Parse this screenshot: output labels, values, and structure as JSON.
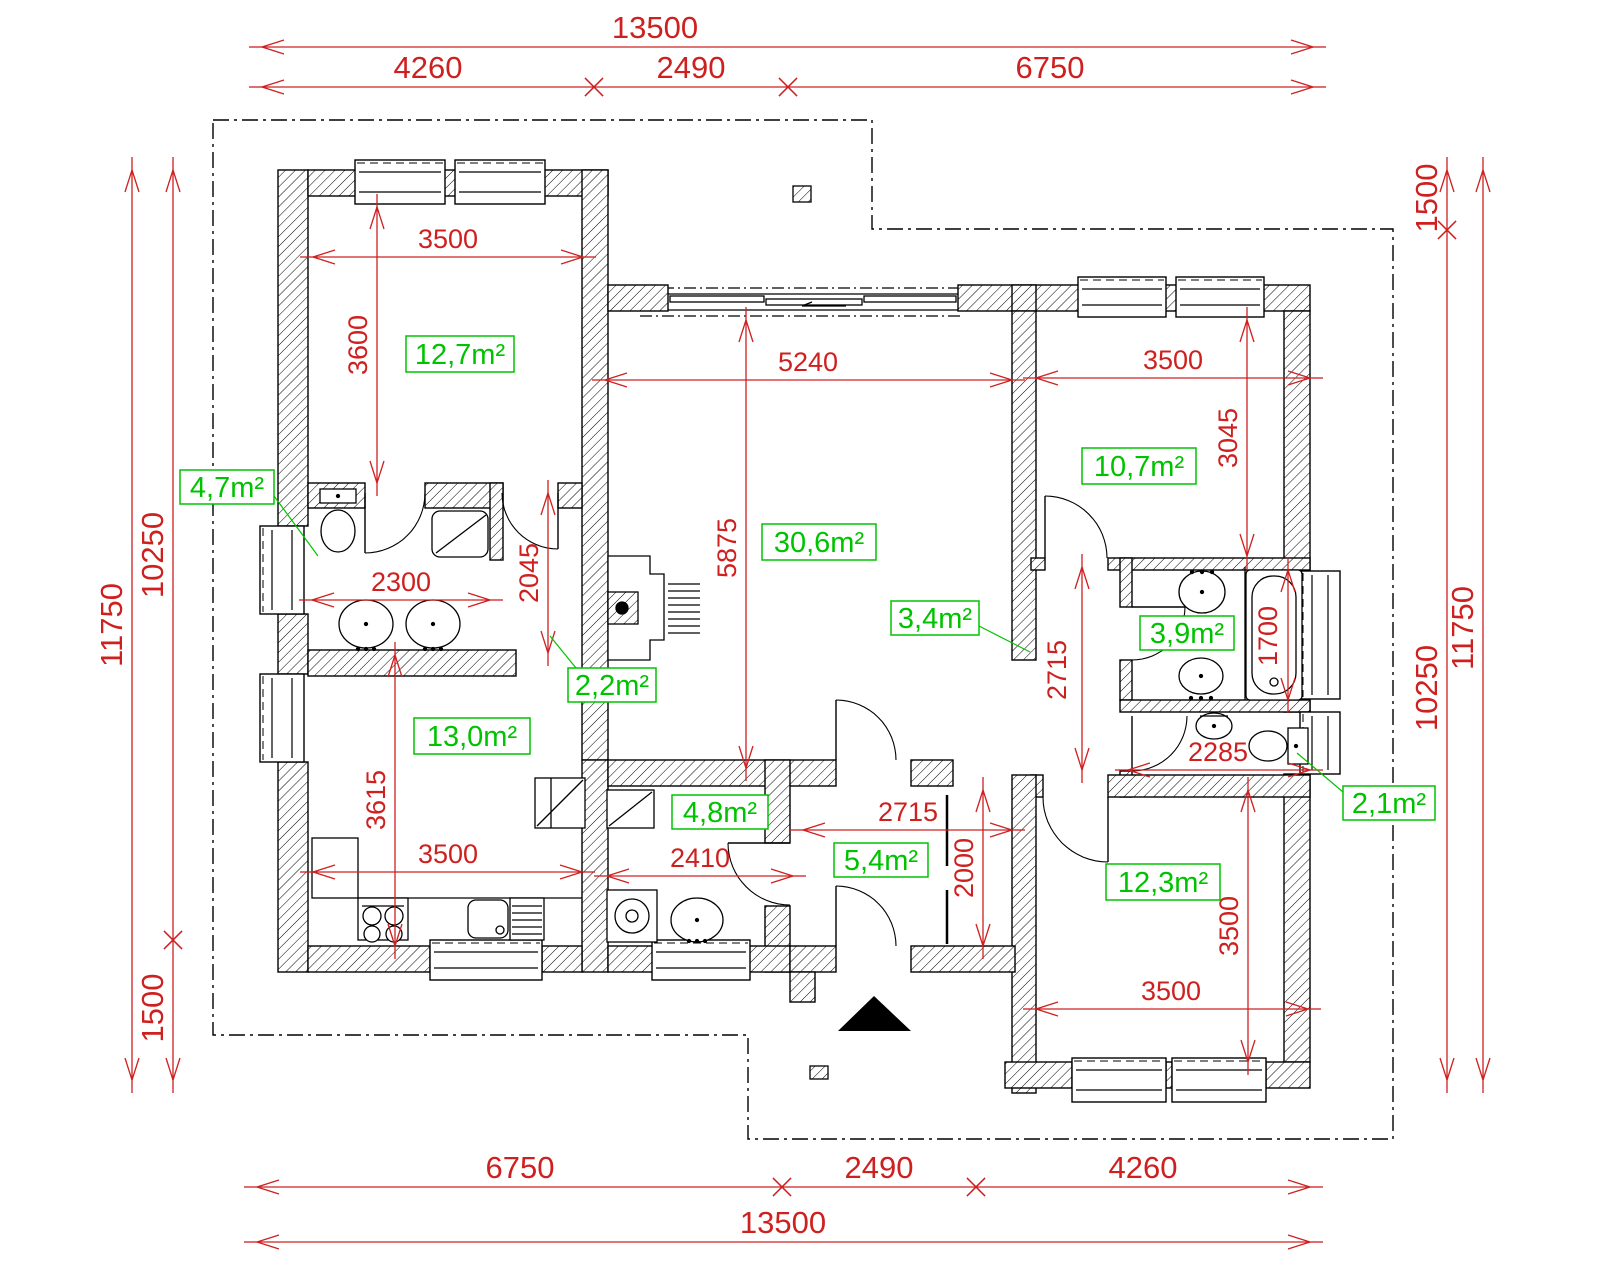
{
  "drawing_title": "house floor plan",
  "colors": {
    "dimension_red": "#cf2020",
    "area_green": "#00c300",
    "line_black": "#000000",
    "background": "#ffffff"
  },
  "dimensions": [
    {
      "label": "13500",
      "ext": true,
      "dir": "h",
      "y": 47,
      "x1": 262,
      "x2": 1313,
      "tx": 655,
      "ty": 38,
      "e1": "arrow",
      "e2": "arrow"
    },
    {
      "label": "4260",
      "ext": true,
      "dir": "h",
      "y": 87,
      "x1": 262,
      "x2": 594,
      "tx": 428,
      "ty": 78,
      "e1": "arrow",
      "e2": "cross"
    },
    {
      "label": "2490",
      "ext": true,
      "dir": "h",
      "y": 87,
      "x1": 594,
      "x2": 788,
      "tx": 691,
      "ty": 78,
      "e1": "cross",
      "e2": "cross"
    },
    {
      "label": "6750",
      "ext": true,
      "dir": "h",
      "y": 87,
      "x1": 788,
      "x2": 1313,
      "tx": 1050,
      "ty": 78,
      "e1": "cross",
      "e2": "arrow"
    },
    {
      "label": "6750",
      "ext": true,
      "dir": "h",
      "y": 1187,
      "x1": 257,
      "x2": 782,
      "tx": 520,
      "ty": 1178,
      "e1": "arrow",
      "e2": "cross"
    },
    {
      "label": "2490",
      "ext": true,
      "dir": "h",
      "y": 1187,
      "x1": 782,
      "x2": 976,
      "tx": 879,
      "ty": 1178,
      "e1": "cross",
      "e2": "cross"
    },
    {
      "label": "4260",
      "ext": true,
      "dir": "h",
      "y": 1187,
      "x1": 976,
      "x2": 1310,
      "tx": 1143,
      "ty": 1178,
      "e1": "cross",
      "e2": "arrow"
    },
    {
      "label": "13500",
      "ext": true,
      "dir": "h",
      "y": 1242,
      "x1": 257,
      "x2": 1310,
      "tx": 783,
      "ty": 1233,
      "e1": "arrow",
      "e2": "arrow"
    },
    {
      "label": "11750",
      "ext": true,
      "dir": "v",
      "x": 132,
      "y1": 170,
      "y2": 1080,
      "tx": 122,
      "ty": 625,
      "e1": "arrow",
      "e2": "arrow"
    },
    {
      "label": "10250",
      "ext": true,
      "dir": "v",
      "x": 173,
      "y1": 170,
      "y2": 940,
      "tx": 163,
      "ty": 555,
      "e1": "arrow",
      "e2": "cross"
    },
    {
      "label": "1500",
      "ext": true,
      "dir": "v",
      "x": 173,
      "y1": 940,
      "y2": 1080,
      "tx": 163,
      "ty": 1008,
      "e1": "cross",
      "e2": "arrow"
    },
    {
      "label": "1500",
      "ext": true,
      "dir": "v",
      "x": 1447,
      "y1": 170,
      "y2": 230,
      "tx": 1437,
      "ty": 198,
      "e1": "arrow",
      "e2": "cross"
    },
    {
      "label": "10250",
      "ext": true,
      "dir": "v",
      "x": 1447,
      "y1": 230,
      "y2": 1080,
      "tx": 1437,
      "ty": 688,
      "e1": "cross",
      "e2": "arrow"
    },
    {
      "label": "11750",
      "ext": true,
      "dir": "v",
      "x": 1483,
      "y1": 170,
      "y2": 1080,
      "tx": 1473,
      "ty": 628,
      "e1": "arrow",
      "e2": "arrow"
    },
    {
      "label": "3500",
      "dir": "h",
      "y": 257,
      "x1": 313,
      "x2": 583,
      "tx": 448,
      "ty": 248,
      "e1": "arrow",
      "e2": "arrow"
    },
    {
      "label": "3600",
      "dir": "v",
      "x": 377,
      "y1": 207,
      "y2": 483,
      "tx": 367,
      "ty": 345,
      "e1": "arrow",
      "e2": "arrow"
    },
    {
      "label": "2300",
      "dir": "h",
      "y": 600,
      "x1": 312,
      "x2": 490,
      "tx": 401,
      "ty": 591,
      "e1": "arrow",
      "e2": "arrow"
    },
    {
      "label": "2045",
      "dir": "v",
      "x": 548,
      "y1": 493,
      "y2": 653,
      "tx": 538,
      "ty": 573,
      "e1": "arrow",
      "e2": "arrow"
    },
    {
      "label": "5240",
      "dir": "h",
      "y": 380,
      "x1": 605,
      "x2": 1012,
      "tx": 808,
      "ty": 371,
      "e1": "arrow",
      "e2": "arrow"
    },
    {
      "label": "5875",
      "dir": "v",
      "x": 746,
      "y1": 320,
      "y2": 768,
      "tx": 736,
      "ty": 548,
      "e1": "arrow",
      "e2": "arrow"
    },
    {
      "label": "3500",
      "dir": "h",
      "y": 378,
      "x1": 1036,
      "x2": 1310,
      "tx": 1173,
      "ty": 369,
      "e1": "arrow",
      "e2": "arrow"
    },
    {
      "label": "3045",
      "dir": "v",
      "x": 1247,
      "y1": 320,
      "y2": 556,
      "tx": 1237,
      "ty": 438,
      "e1": "arrow",
      "e2": "arrow"
    },
    {
      "label": "1700",
      "dir": "v",
      "x": 1288,
      "y1": 570,
      "y2": 700,
      "tx": 1277,
      "ty": 636,
      "e1": "arrow",
      "e2": "arrow"
    },
    {
      "label": "2715",
      "dir": "v",
      "x": 1082,
      "y1": 567,
      "y2": 770,
      "tx": 1066,
      "ty": 670,
      "e1": "arrow",
      "e2": "arrow"
    },
    {
      "label": "2715",
      "dir": "h",
      "y": 830,
      "x1": 803,
      "x2": 1012,
      "tx": 908,
      "ty": 821,
      "e1": "arrow",
      "e2": "arrow"
    },
    {
      "label": "2000",
      "dir": "v",
      "x": 983,
      "y1": 790,
      "y2": 946,
      "tx": 973,
      "ty": 868,
      "e1": "arrow",
      "e2": "arrow"
    },
    {
      "label": "2285",
      "dir": "h",
      "y": 770,
      "x1": 1128,
      "x2": 1310,
      "tx": 1218,
      "ty": 761,
      "e1": "arrow",
      "e2": "arrow"
    },
    {
      "label": "3500",
      "dir": "v",
      "x": 1248,
      "y1": 790,
      "y2": 1062,
      "tx": 1238,
      "ty": 926,
      "e1": "arrow",
      "e2": "arrow"
    },
    {
      "label": "3500",
      "dir": "h",
      "y": 1009,
      "x1": 1036,
      "x2": 1308,
      "tx": 1171,
      "ty": 1000,
      "e1": "arrow",
      "e2": "arrow"
    },
    {
      "label": "3615",
      "dir": "v",
      "x": 395,
      "y1": 655,
      "y2": 946,
      "tx": 385,
      "ty": 800,
      "e1": "arrow",
      "e2": "arrow"
    },
    {
      "label": "3500",
      "dir": "h",
      "y": 872,
      "x1": 313,
      "x2": 582,
      "tx": 448,
      "ty": 863,
      "e1": "arrow",
      "e2": "arrow"
    },
    {
      "label": "2410",
      "dir": "h",
      "y": 876,
      "x1": 607,
      "x2": 793,
      "tx": 700,
      "ty": 867,
      "e1": "arrow",
      "e2": "arrow"
    }
  ],
  "room_areas": [
    {
      "label": "12,7m²",
      "x": 406,
      "y": 336,
      "w": 108,
      "h": 36
    },
    {
      "label": "4,7m²",
      "x": 180,
      "y": 470,
      "w": 94,
      "h": 34,
      "leader": [
        [
          274,
          496
        ],
        [
          318,
          556
        ]
      ]
    },
    {
      "label": "2,2m²",
      "x": 568,
      "y": 668,
      "w": 88,
      "h": 34,
      "leader": [
        [
          550,
          636
        ],
        [
          576,
          668
        ]
      ]
    },
    {
      "label": "13,0m²",
      "x": 414,
      "y": 718,
      "w": 116,
      "h": 36
    },
    {
      "label": "30,6m²",
      "x": 762,
      "y": 524,
      "w": 114,
      "h": 36
    },
    {
      "label": "3,4m²",
      "x": 891,
      "y": 601,
      "w": 88,
      "h": 34,
      "leader": [
        [
          979,
          626
        ],
        [
          1030,
          652
        ]
      ]
    },
    {
      "label": "10,7m²",
      "x": 1082,
      "y": 448,
      "w": 114,
      "h": 36
    },
    {
      "label": "3,9m²",
      "x": 1140,
      "y": 616,
      "w": 94,
      "h": 34
    },
    {
      "label": "2,1m²",
      "x": 1343,
      "y": 786,
      "w": 92,
      "h": 34,
      "leader": [
        [
          1343,
          792
        ],
        [
          1297,
          753
        ]
      ]
    },
    {
      "label": "12,3m²",
      "x": 1106,
      "y": 864,
      "w": 114,
      "h": 36
    },
    {
      "label": "5,4m²",
      "x": 834,
      "y": 843,
      "w": 94,
      "h": 34
    },
    {
      "label": "4,8m²",
      "x": 672,
      "y": 795,
      "w": 96,
      "h": 34
    }
  ]
}
